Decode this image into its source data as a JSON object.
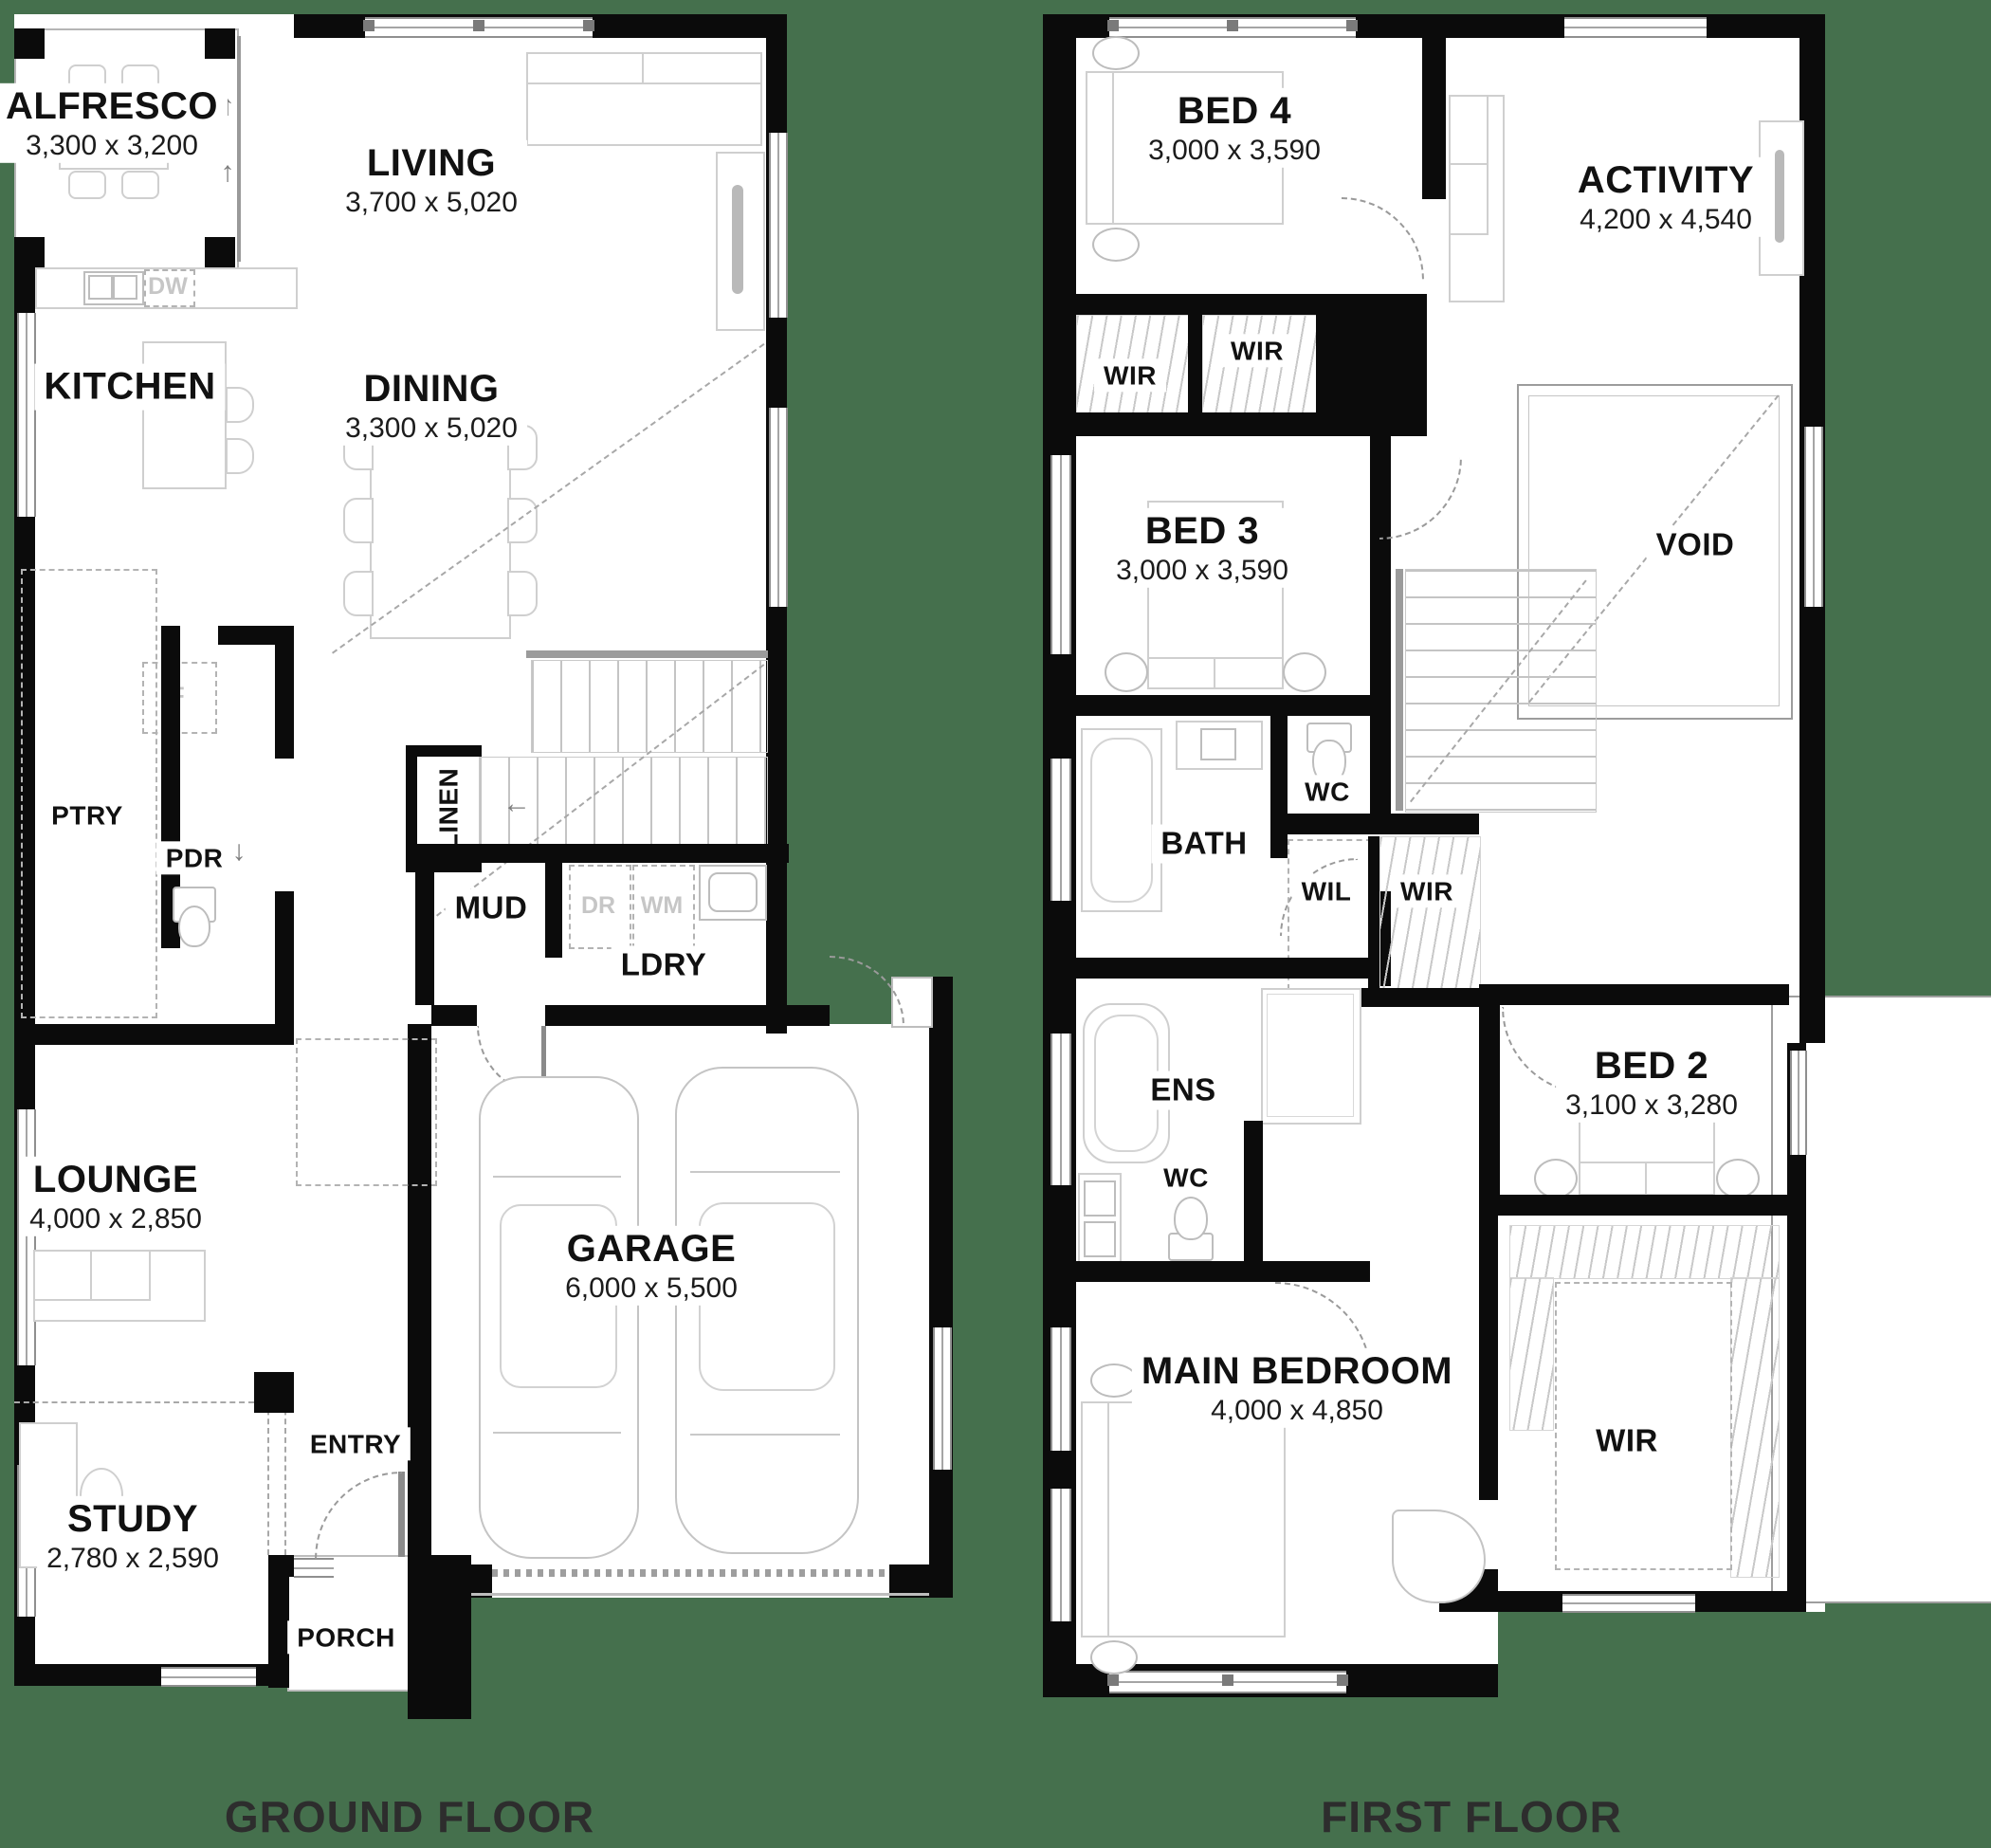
{
  "page": {
    "background_color": "#45704D",
    "wall_color": "#0b0b0b",
    "plan_color": "#ffffff"
  },
  "icons": {
    "up_arrow": "↑",
    "down_arrow": "↓",
    "left_arrow": "←"
  },
  "floors": [
    {
      "label": "GROUND FLOOR",
      "rooms": [
        {
          "name": "ALFRESCO",
          "dims": "3,300 x 3,200"
        },
        {
          "name": "LIVING",
          "dims": "3,700 x 5,020"
        },
        {
          "name": "KITCHEN",
          "dims": ""
        },
        {
          "name": "DINING",
          "dims": "3,300 x 5,020"
        },
        {
          "name": "PTRY",
          "dims": ""
        },
        {
          "name": "PDR",
          "dims": ""
        },
        {
          "name": "LINEN",
          "dims": ""
        },
        {
          "name": "MUD",
          "dims": ""
        },
        {
          "name": "LDRY",
          "dims": ""
        },
        {
          "name": "LOUNGE",
          "dims": "4,000 x 2,850"
        },
        {
          "name": "STUDY",
          "dims": "2,780 x 2,590"
        },
        {
          "name": "ENTRY",
          "dims": ""
        },
        {
          "name": "PORCH",
          "dims": ""
        },
        {
          "name": "GARAGE",
          "dims": "6,000 x 5,500"
        }
      ],
      "appliances": {
        "dw": "DW",
        "fridge": "F",
        "dryer": "DR",
        "washer": "WM"
      }
    },
    {
      "label": "FIRST FLOOR",
      "rooms": [
        {
          "name": "BED 4",
          "dims": "3,000 x 3,590"
        },
        {
          "name": "ACTIVITY",
          "dims": "4,200 x 4,540"
        },
        {
          "name": "WIR",
          "dims": ""
        },
        {
          "name": "WIR",
          "dims": ""
        },
        {
          "name": "BED 3",
          "dims": "3,000 x 3,590"
        },
        {
          "name": "VOID",
          "dims": ""
        },
        {
          "name": "BATH",
          "dims": ""
        },
        {
          "name": "WC",
          "dims": ""
        },
        {
          "name": "WIL",
          "dims": ""
        },
        {
          "name": "WIR",
          "dims": ""
        },
        {
          "name": "ENS",
          "dims": ""
        },
        {
          "name": "WC",
          "dims": ""
        },
        {
          "name": "BED 2",
          "dims": "3,100 x 3,280"
        },
        {
          "name": "MAIN BEDROOM",
          "dims": "4,000 x 4,850"
        },
        {
          "name": "WIR",
          "dims": ""
        }
      ]
    }
  ]
}
